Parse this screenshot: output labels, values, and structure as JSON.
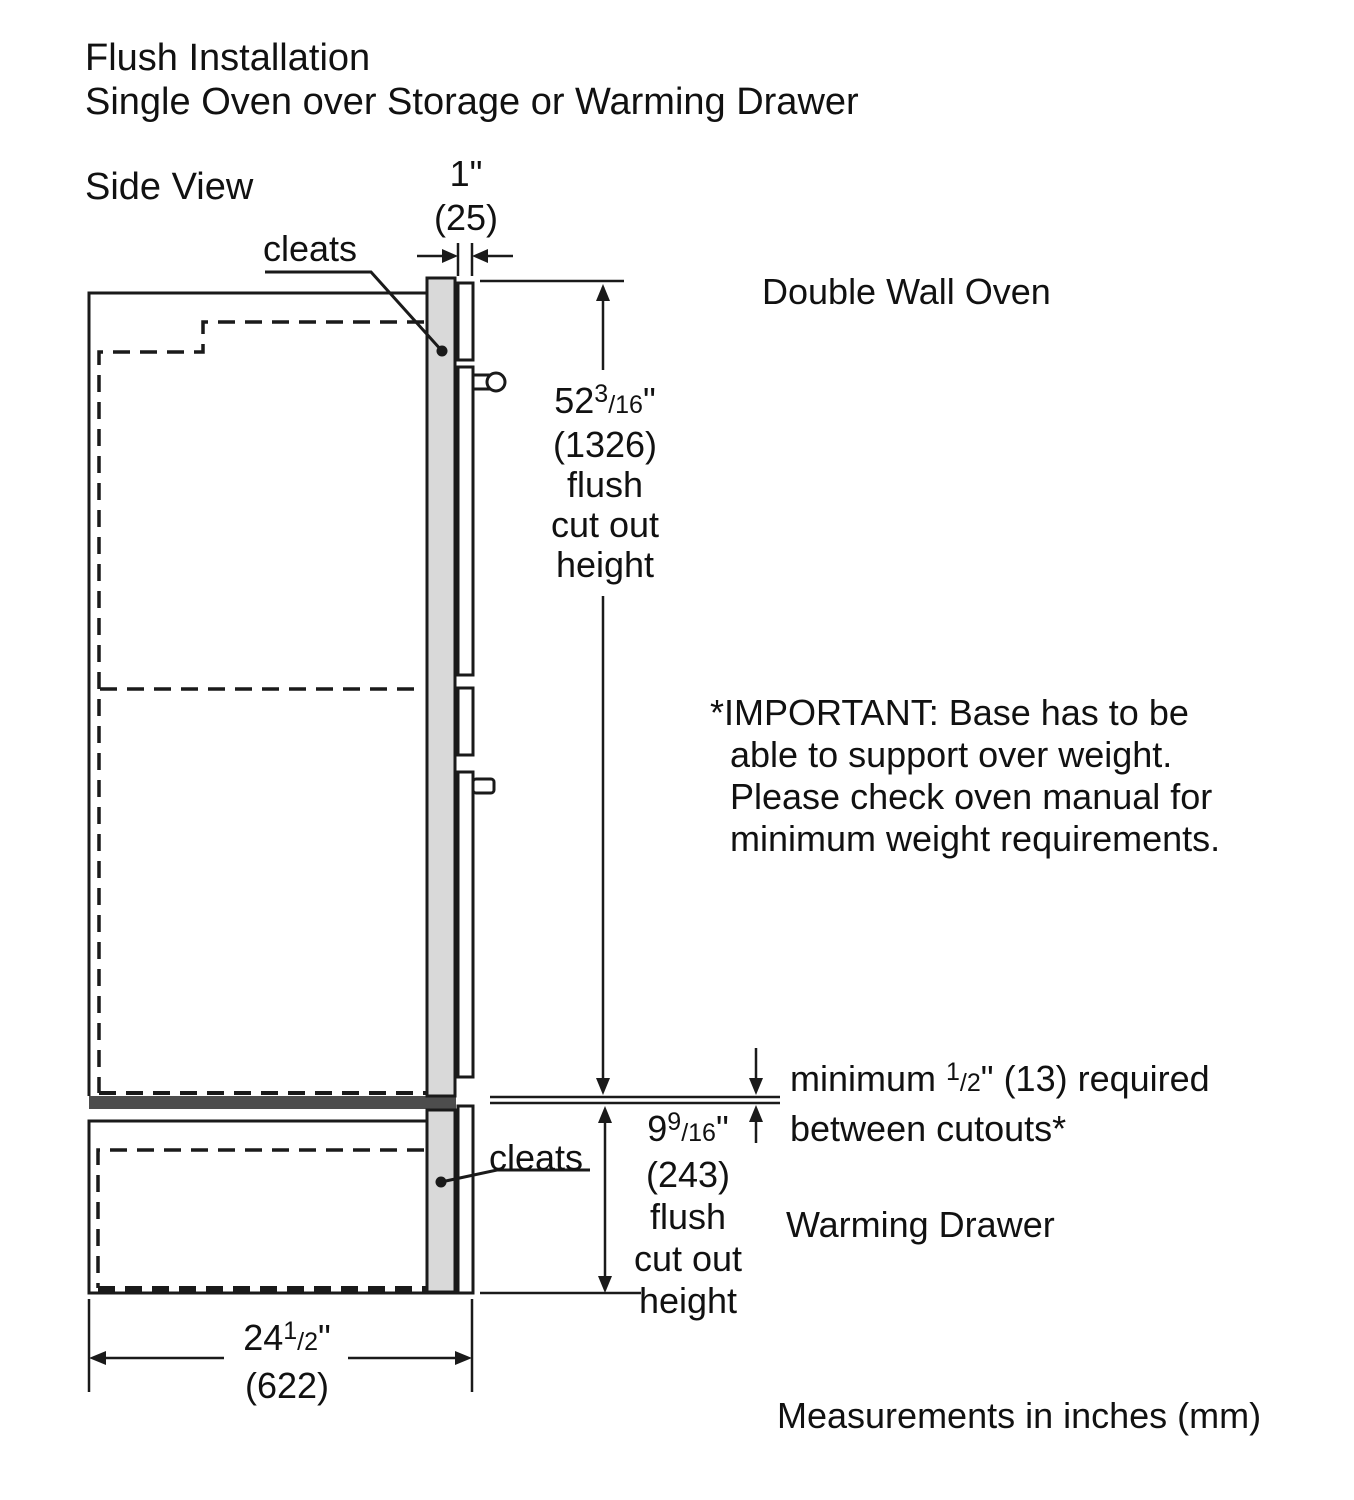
{
  "header": {
    "title_line1": "Flush Installation",
    "title_line2": "Single Oven over Storage or Warming Drawer"
  },
  "side_view_label": "Side View",
  "diagram_labels": {
    "cleats_upper": "cleats",
    "cleats_lower": "cleats",
    "double_wall_oven": "Double Wall Oven",
    "warming_drawer": "Warming Drawer"
  },
  "dim_top_gap": {
    "inches": "1\"",
    "mm": "(25)"
  },
  "dim_oven_cutout": {
    "whole": "52",
    "frac_sup": "3",
    "frac_rest": "/16",
    "unit": "\"",
    "mm": "(1326)",
    "line3": "flush",
    "line4": "cut out",
    "line5": "height"
  },
  "dim_drawer_cutout": {
    "whole": "9",
    "frac_sup": "9",
    "frac_rest": "/16",
    "unit": "\"",
    "mm": "(243)",
    "line3": "flush",
    "line4": "cut out",
    "line5": "height"
  },
  "dim_width": {
    "whole": "24",
    "frac_sup": "1",
    "frac_rest": "/2",
    "unit": "\"",
    "mm": "(622)"
  },
  "min_gap_note": {
    "prefix": "minimum ",
    "frac_sup": "1",
    "frac_rest": "/2",
    "suffix": "\" (13) required",
    "line2": "between cutouts*"
  },
  "important_note": {
    "line1": "*IMPORTANT: Base has to be",
    "line2": "able to support over weight.",
    "line3": "Please check oven manual for",
    "line4": "minimum weight requirements."
  },
  "footer": "Measurements in inches (mm)",
  "colors": {
    "line": "#1a1a1a",
    "cleat_fill": "#d9d9d9",
    "base_bar_fill": "#4d4d4d"
  }
}
